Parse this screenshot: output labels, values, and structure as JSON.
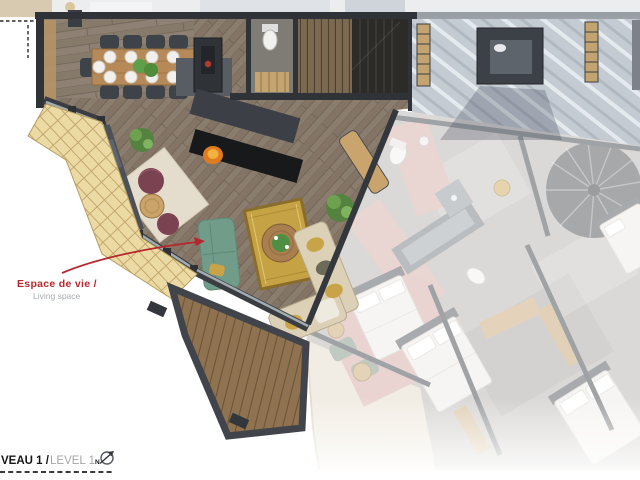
{
  "annotations": {
    "living_space_label_fr": "Espace de vie /",
    "living_space_label_en": "Living space"
  },
  "footer": {
    "level_label_bold": "VEAU 1 /",
    "level_label_light": "LEVEL 1",
    "north_letter": "N"
  },
  "colors": {
    "accent_red": "#b5272d",
    "label_gray": "#a8acb0",
    "footer_dark": "#161616",
    "footer_gray": "#a6a6a6",
    "wall_dark": "#2f3337",
    "sofa_teal": "#719c89",
    "rug_gold": "#c5a243",
    "sectional_cream": "#dcd0b6",
    "pouf_maroon": "#7b4351",
    "corridor_pink": "#d2a7a2",
    "fire_orange": "#e07b1f",
    "deck_brown": "#8f7350",
    "roof_gray": "#c5cbd3",
    "shingle_yellow": "#ecdaa4"
  }
}
